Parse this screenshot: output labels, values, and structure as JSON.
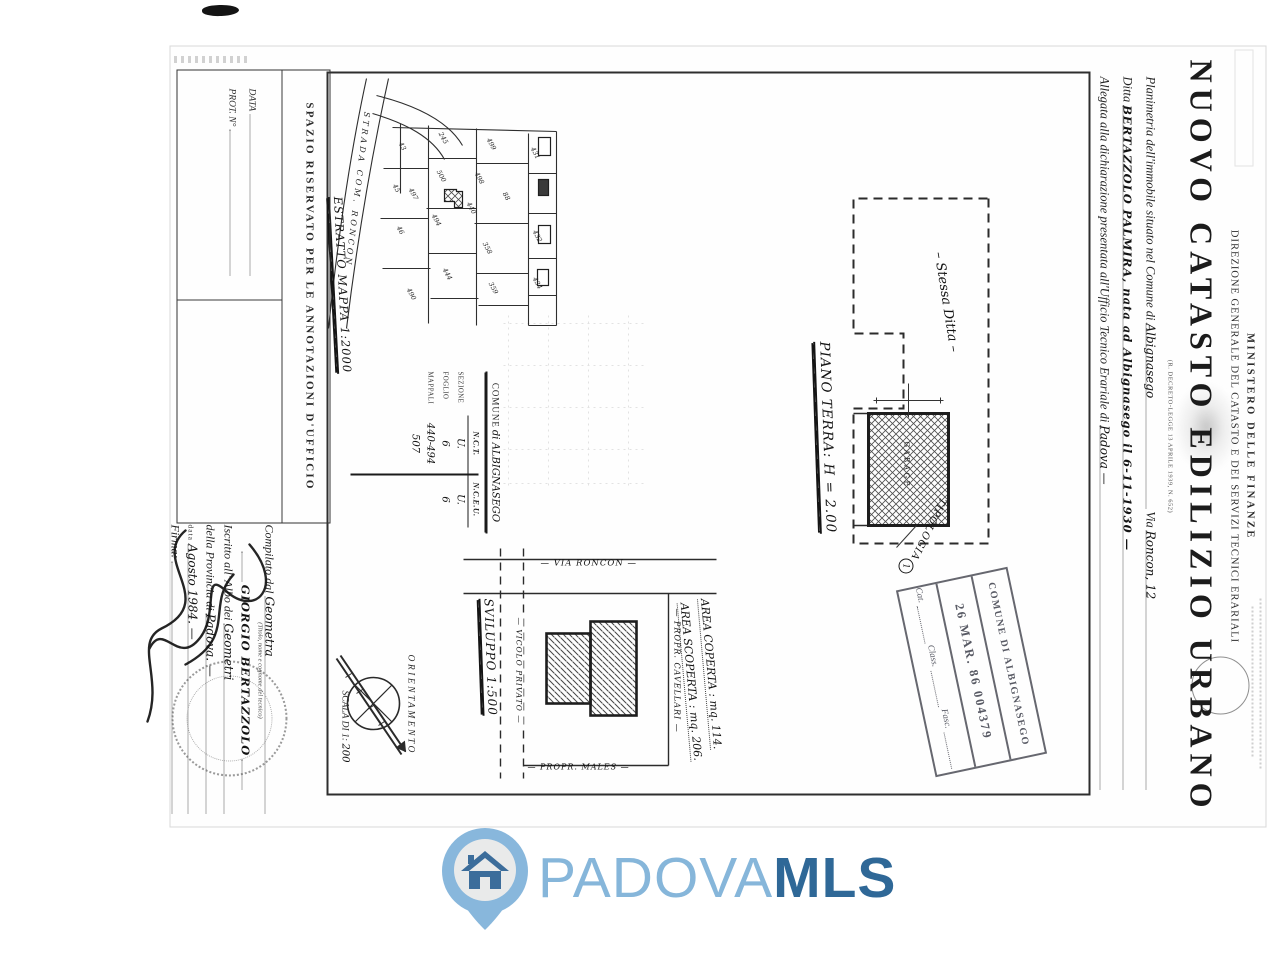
{
  "header": {
    "ministry": "MINISTERO DELLE FINANZE",
    "direction": "DIREZIONE GENERALE DEL CATASTO E DEI SERVIZI TECNICI ERARIALI",
    "decree": "(R. DECRETO-LEGGE 13 APRILE 1939, N. 652)",
    "title": "NUOVO CATASTO EDILIZIO URBANO",
    "line1_label": "Planimetria dell'immobile situato nel Comune di",
    "line1_value": "Albignasego",
    "line1_via_label": "Via",
    "line1_via_value": "Roncon, 12",
    "line2_label": "Ditta",
    "line2_value": "BERTAZZOLO PALMIRA, nata ad Albignasego il 6-11-1930 —",
    "line3_label": "Allegata alla dichiarazione presentata all'Ufficio Tecnico Erariale di",
    "line3_value": "Padova —"
  },
  "map": {
    "caption": "ESTRATTO MAPPA 1:2000",
    "road_label": "STRADA COM. RONCON",
    "parcels": [
      "431",
      "88",
      "432",
      "434",
      "499",
      "498",
      "358",
      "359",
      "245",
      "500",
      "440",
      "494",
      "497",
      "444",
      "43",
      "45",
      "46",
      "490"
    ]
  },
  "floor_plan": {
    "caption": "PIANO TERRA: H = 2.00",
    "note": "– Stessa Ditta –",
    "garage": "GARAGE",
    "typology_label": "TIPOLOGIA",
    "typology_number": "1"
  },
  "site_plan": {
    "caption": "SVILUPPO 1:500",
    "road_main": "— VIA RONCON —",
    "road_private": "— VICOLO PRIVATO —",
    "neighbor_top": "— PROPR. CAVELLARI —",
    "neighbor_right": "— PROPR. MALES —",
    "area_covered": "AREA COPERTA : mq. 114.",
    "area_open": "AREA SCOPERTA : mq. 206."
  },
  "comune_table": {
    "title_label": "COMUNE",
    "title_value": "di ALBIGNASEGO",
    "col1": "N.C.T.",
    "col2": "N.C.E.U.",
    "rows": [
      {
        "label": "SEZIONE",
        "nct": "U.",
        "nceu": "U."
      },
      {
        "label": "FOGLIO",
        "nct": "6",
        "nceu": "6"
      },
      {
        "label": "MAPPALI",
        "nct": "440-494",
        "nceu": ""
      },
      {
        "label": "",
        "nct": "507",
        "nceu": ""
      }
    ]
  },
  "orientation": {
    "label": "ORIENTAMENTO",
    "scale_label": "SCALA DI 1:",
    "scale_value": "200"
  },
  "registry_stamp": {
    "line1": "COMUNE DI ALBIGNASEGO",
    "line2": "26 MAR. 86   004379",
    "cat": "Cat.",
    "class": "Class.",
    "fasc": "Fasc."
  },
  "annotations_box": {
    "title": "SPAZIO RISERVATO PER LE ANNOTAZIONI D'UFFICIO",
    "data_label": "DATA",
    "prot_label": "PROT. N°"
  },
  "compiler": {
    "l1": "Compilato dal",
    "l1_value": "Geometra",
    "l1_caption": "(Titolo, nome e cognome del tecnico)",
    "name": "GIORGIO BERTAZZOLO",
    "l2": "Iscritto all' Albo dei",
    "l2_value": "Geometri",
    "l3": "della Provincia di",
    "l3_value": "Padova. —",
    "l4": "data",
    "l4_value": "Agosto 1984. —",
    "l5": "Firma:"
  },
  "watermark": {
    "brand1": "PADOVA",
    "brand2": "MLS",
    "light_blue": "#86b6da",
    "dark_blue": "#2f6897"
  }
}
